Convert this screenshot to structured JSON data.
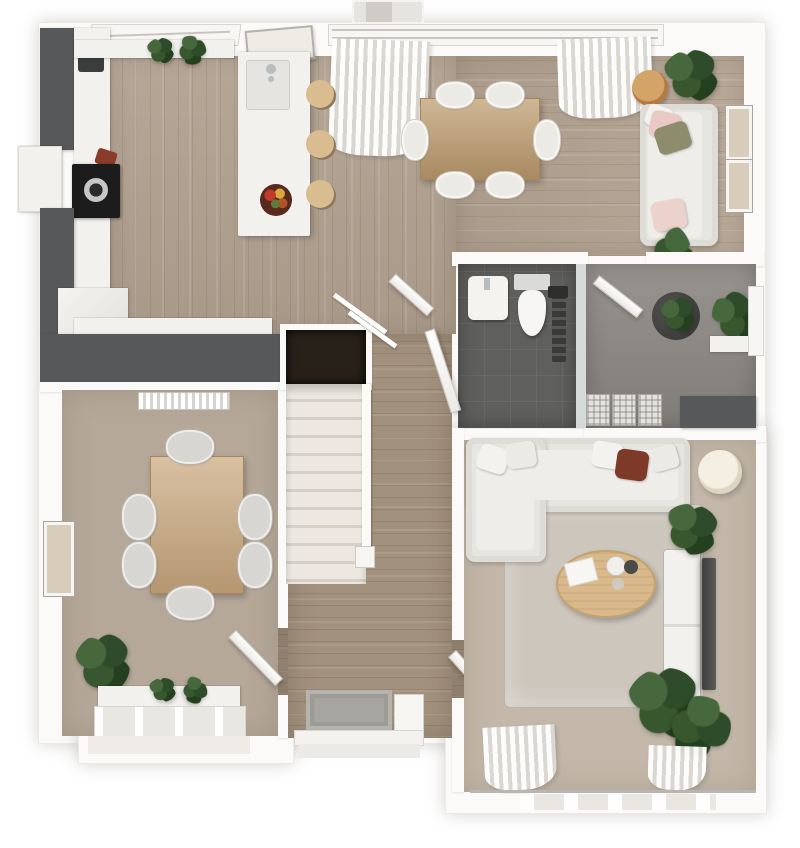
{
  "scene": {
    "type": "3d-floor-plan-render",
    "view": "top-down ground floor, no text labels visible",
    "background": "#ffffff"
  },
  "palette": {
    "wall_white": "#fbfaf8",
    "wood_floor": "#b1a190",
    "hall_wood": "#a2917d",
    "charcoal_units": "#56585a",
    "cabinet_white": "#f2f1ee",
    "taupe_carpet": "#b5a899",
    "living_carpet": "#c2b7a8",
    "rug_grey": "#ccc6bc",
    "bath_tile_dark": "#5f5f5d",
    "entry_tile_grey": "#8d8a85",
    "oak_table": "#bf9c6e",
    "family_table": "#c9a87e",
    "coffee_table": "#d9b88b",
    "stool_wood": "#d9bc90",
    "side_table_tan": "#c08a52",
    "sofa_fabric": "#e7e5e0",
    "cushion_pink": "#e9c9c3",
    "cushion_olive": "#8d8d6e",
    "throw_rust": "#7d3a29",
    "plant_green": "#34522f",
    "stair_void": "#28211a",
    "doormat_grey": "#a6a5a0",
    "hob_black": "#1c1c1c"
  },
  "rooms": [
    {
      "id": "kitchen_dining",
      "name": "open-plan kitchen and dining room",
      "floor": "wood planks",
      "furniture": [
        "charcoal tall unit",
        "charcoal L-shaped worktop",
        "white cabinet run",
        "black hob with pan",
        "bay window",
        "kitchen island with sink and tap",
        "fruit bowl",
        "3 round bar stools",
        "wall art panel",
        "windowsill plants",
        "large window with curtains",
        "oak dining table",
        "6 white chairs",
        "fabric sofa",
        "pink and olive cushions",
        "round tan side table",
        "2 plants",
        "2 picture frames on right wall"
      ]
    },
    {
      "id": "wc",
      "name": "cloakroom wc",
      "floor": "dark grey tile",
      "furniture": [
        "wall hung basin",
        "toilet",
        "dark towel radiator",
        "glass screen"
      ]
    },
    {
      "id": "entry_hall",
      "name": "entrance hall",
      "floor": "grey tile",
      "furniture": [
        "open door",
        "dark plant pot",
        "window with plant and ledge",
        "3 storage baskets",
        "charcoal bench"
      ]
    },
    {
      "id": "hallway_stairs",
      "name": "hallway and staircase",
      "floor": "wood planks",
      "furniture": [
        "stair void opening",
        "staircase with banister and newel",
        "handrails",
        "double doors to dining",
        "door to living room",
        "doormat",
        "front door"
      ]
    },
    {
      "id": "family_room",
      "name": "family dining room",
      "floor": "taupe carpet",
      "furniture": [
        "radiator",
        "wood table",
        "6 grey chairs",
        "corner plant in pot",
        "picture frame",
        "window with sill plants",
        "open door"
      ]
    },
    {
      "id": "living_room",
      "name": "living room",
      "floor": "carpet with grey rug",
      "furniture": [
        "corner sofa with chaise",
        "white scatter cushions",
        "rust throw",
        "oval wood coffee table with book and mugs",
        "white tv unit",
        "wall mounted tv",
        "floor lamp",
        "2 large plants",
        "patio window with curtains",
        "open door"
      ]
    }
  ],
  "counts": {
    "bar_stools": 3,
    "dining_chairs_top": 6,
    "family_chairs": 6,
    "baskets": 3,
    "picture_frames_right_wall": 2,
    "stair_treads_visible": 11
  }
}
